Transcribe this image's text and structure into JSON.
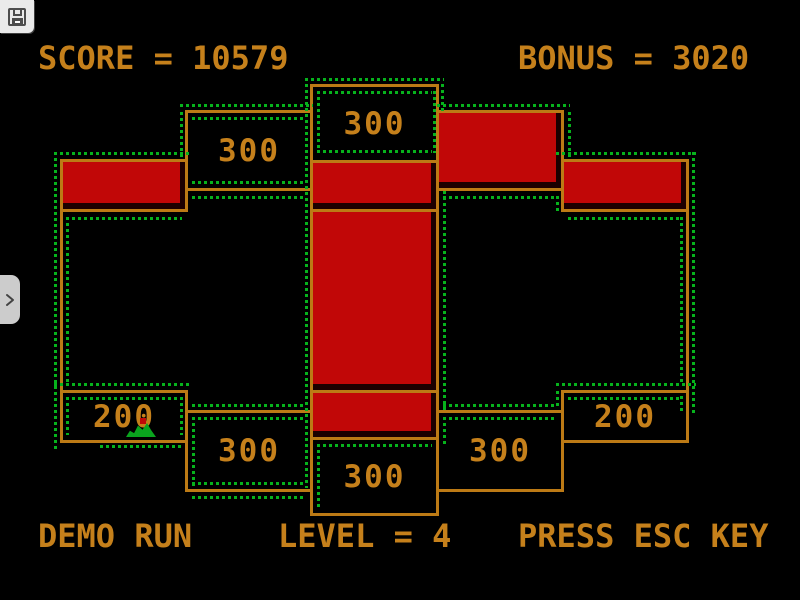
{
  "colors": {
    "background": "#000000",
    "orange_text": "#c5801b",
    "orange_line": "#bc7a15",
    "red_fill": "#c10707",
    "trail_green": "#06b21c",
    "player_green": "#0aa41e",
    "overlay_gray": "#eaeaea",
    "overlay_icon_gray": "#4d4d4d"
  },
  "hud": {
    "score_text": "SCORE = 10579",
    "bonus_text": "BONUS = 3020",
    "demo_text": "DEMO RUN",
    "level_text": "LEVEL = 4",
    "esc_text": "PRESS ESC KEY",
    "score_value": 10579,
    "bonus_value": 3020,
    "level_value": 4
  },
  "overlay": {
    "save_button": {
      "icon": "floppy-disk-icon"
    },
    "drawer_toggle": {
      "icon": "chevron-right-icon"
    }
  },
  "board": {
    "cells": [
      {
        "name": "region-top-center",
        "x": 310,
        "y": 84,
        "w": 129,
        "h": 79,
        "type": "value",
        "value": "300"
      },
      {
        "name": "region-top-left",
        "x": 185,
        "y": 110,
        "w": 128,
        "h": 81,
        "type": "value",
        "value": "300"
      },
      {
        "name": "region-top-right",
        "x": 436,
        "y": 110,
        "w": 128,
        "h": 81,
        "type": "red",
        "value": null
      },
      {
        "name": "region-left-upper",
        "x": 60,
        "y": 159,
        "w": 128,
        "h": 53,
        "type": "red",
        "value": null
      },
      {
        "name": "region-right-upper",
        "x": 561,
        "y": 159,
        "w": 128,
        "h": 53,
        "type": "red",
        "value": null
      },
      {
        "name": "region-center-upper",
        "x": 310,
        "y": 160,
        "w": 129,
        "h": 52,
        "type": "red",
        "value": null
      },
      {
        "name": "region-center-middle",
        "x": 310,
        "y": 209,
        "w": 129,
        "h": 184,
        "type": "red",
        "value": null
      },
      {
        "name": "region-center-lower",
        "x": 310,
        "y": 390,
        "w": 129,
        "h": 50,
        "type": "red",
        "value": null
      },
      {
        "name": "region-left-lower",
        "x": 60,
        "y": 390,
        "w": 128,
        "h": 53,
        "type": "value",
        "value": "200"
      },
      {
        "name": "region-right-lower",
        "x": 561,
        "y": 390,
        "w": 128,
        "h": 53,
        "type": "value",
        "value": "200"
      },
      {
        "name": "region-bottom-left",
        "x": 185,
        "y": 410,
        "w": 128,
        "h": 82,
        "type": "value",
        "value": "300"
      },
      {
        "name": "region-bottom-right",
        "x": 436,
        "y": 410,
        "w": 128,
        "h": 82,
        "type": "value",
        "value": "300"
      },
      {
        "name": "region-bottom-center",
        "x": 310,
        "y": 437,
        "w": 129,
        "h": 79,
        "type": "value",
        "value": "300"
      }
    ],
    "lines": [
      {
        "o": "v",
        "x": 60,
        "y": 212,
        "len": 178
      },
      {
        "o": "v",
        "x": 686,
        "y": 212,
        "len": 178
      }
    ],
    "trail": [
      {
        "o": "h",
        "x": 305,
        "y": 78,
        "len": 139
      },
      {
        "o": "h",
        "x": 317,
        "y": 91,
        "len": 115
      },
      {
        "o": "h",
        "x": 317,
        "y": 150,
        "len": 115
      },
      {
        "o": "h",
        "x": 180,
        "y": 104,
        "len": 133
      },
      {
        "o": "h",
        "x": 437,
        "y": 104,
        "len": 133
      },
      {
        "o": "h",
        "x": 192,
        "y": 117,
        "len": 114
      },
      {
        "o": "h",
        "x": 192,
        "y": 181,
        "len": 114
      },
      {
        "o": "h",
        "x": 54,
        "y": 152,
        "len": 137
      },
      {
        "o": "h",
        "x": 556,
        "y": 152,
        "len": 140
      },
      {
        "o": "h",
        "x": 192,
        "y": 196,
        "len": 114
      },
      {
        "o": "h",
        "x": 443,
        "y": 196,
        "len": 114
      },
      {
        "o": "h",
        "x": 66,
        "y": 217,
        "len": 116
      },
      {
        "o": "h",
        "x": 568,
        "y": 217,
        "len": 115
      },
      {
        "o": "h",
        "x": 54,
        "y": 383,
        "len": 137
      },
      {
        "o": "h",
        "x": 556,
        "y": 383,
        "len": 140
      },
      {
        "o": "h",
        "x": 66,
        "y": 397,
        "len": 116
      },
      {
        "o": "h",
        "x": 568,
        "y": 397,
        "len": 112
      },
      {
        "o": "h",
        "x": 192,
        "y": 404,
        "len": 114
      },
      {
        "o": "h",
        "x": 443,
        "y": 404,
        "len": 114
      },
      {
        "o": "h",
        "x": 192,
        "y": 417,
        "len": 114
      },
      {
        "o": "h",
        "x": 443,
        "y": 417,
        "len": 114
      },
      {
        "o": "h",
        "x": 317,
        "y": 444,
        "len": 115
      },
      {
        "o": "h",
        "x": 192,
        "y": 482,
        "len": 114
      },
      {
        "o": "h",
        "x": 192,
        "y": 496,
        "len": 114
      },
      {
        "o": "h",
        "x": 100,
        "y": 445,
        "len": 84
      },
      {
        "o": "v",
        "x": 305,
        "y": 84,
        "len": 404
      },
      {
        "o": "v",
        "x": 317,
        "y": 91,
        "len": 62
      },
      {
        "o": "v",
        "x": 433,
        "y": 91,
        "len": 62
      },
      {
        "o": "v",
        "x": 441,
        "y": 84,
        "len": 28
      },
      {
        "o": "v",
        "x": 180,
        "y": 112,
        "len": 46
      },
      {
        "o": "v",
        "x": 568,
        "y": 112,
        "len": 46
      },
      {
        "o": "v",
        "x": 443,
        "y": 191,
        "len": 220
      },
      {
        "o": "v",
        "x": 443,
        "y": 417,
        "len": 30
      },
      {
        "o": "v",
        "x": 54,
        "y": 152,
        "len": 298
      },
      {
        "o": "v",
        "x": 66,
        "y": 217,
        "len": 166
      },
      {
        "o": "v",
        "x": 66,
        "y": 397,
        "len": 38
      },
      {
        "o": "v",
        "x": 180,
        "y": 397,
        "len": 38
      },
      {
        "o": "v",
        "x": 192,
        "y": 417,
        "len": 70
      },
      {
        "o": "v",
        "x": 556,
        "y": 196,
        "len": 18
      },
      {
        "o": "v",
        "x": 556,
        "y": 391,
        "len": 18
      },
      {
        "o": "v",
        "x": 680,
        "y": 217,
        "len": 166
      },
      {
        "o": "v",
        "x": 680,
        "y": 396,
        "len": 18
      },
      {
        "o": "v",
        "x": 692,
        "y": 152,
        "len": 262
      },
      {
        "o": "v",
        "x": 317,
        "y": 444,
        "len": 66
      }
    ],
    "player": {
      "x": 126,
      "y": 423,
      "w": 30,
      "h": 14,
      "dot_x": 140,
      "dot_y": 418,
      "dot_size": 6
    }
  }
}
